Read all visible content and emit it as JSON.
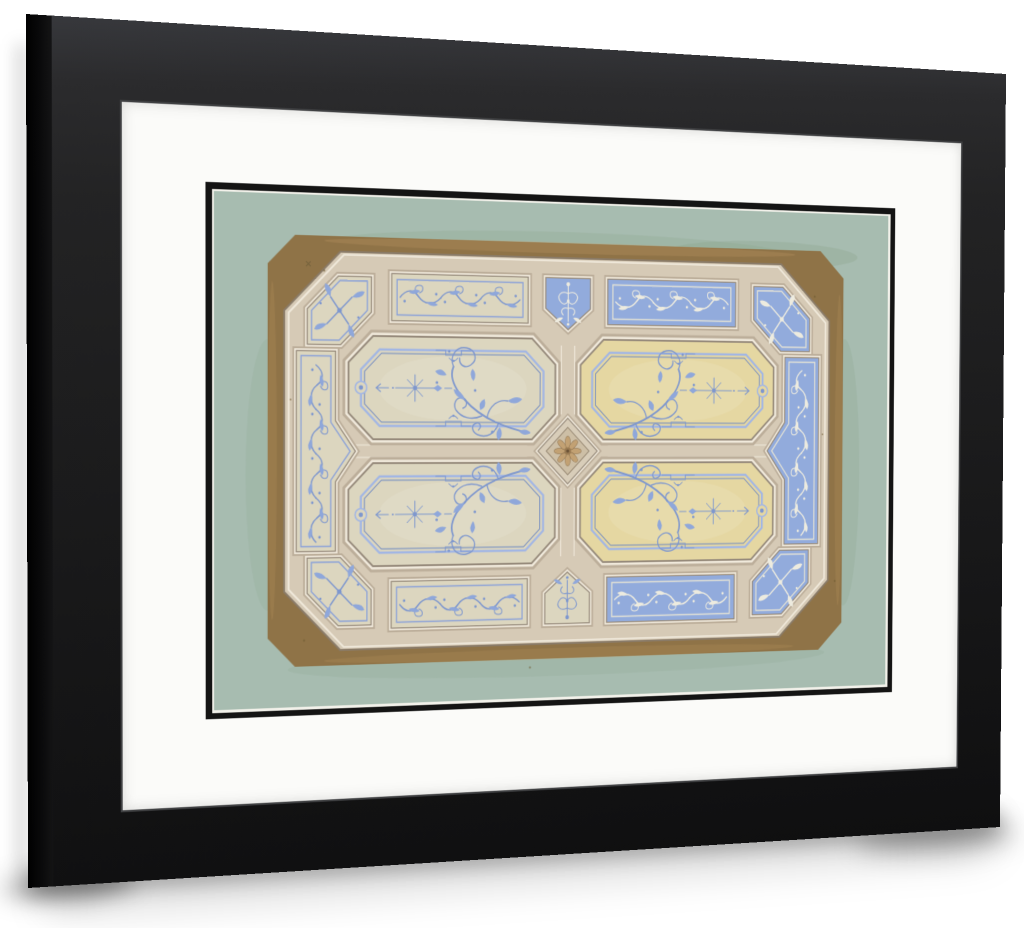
{
  "palette": {
    "page_bg": "#ffffff",
    "frame_hi": "#37383c",
    "frame_mid": "#232324",
    "frame_dark": "#0f0f10",
    "frame_wall": "#0a0a0b",
    "frame_lip": "#3f4042",
    "mat": "#fbfbf9",
    "fillet": "#141414",
    "fillet_gap": "#f2f1ea",
    "sage": "#a7bcb0",
    "sage_stain": "#7f9a7c",
    "speck": "#6f5b31",
    "brown": "#8f7347",
    "brown_hi": "#c29c66",
    "beam": "#d6cab6",
    "beam_m1": "#bcae9a",
    "beam_m2": "#f0e9db",
    "beam_m3": "#968a7b",
    "beam_edge": "#8a7b68",
    "panel_cream": "#dcd6bf",
    "panel_gold": "#e5d7a2",
    "panel_blue": "#92abdc",
    "orn_blue": "#7e97ce",
    "orn_blue_fill": "#8fa7da",
    "line_on_cream": "#8ca2d8",
    "orn_white": "#edebdf",
    "line_on_blue": "#e2e1d5",
    "cof_line_hi": "#a2b6e4",
    "cof_line_dk": "#6f89c1",
    "ros_base": "#d8cdb9",
    "ros_inner": "#cdbfa6",
    "ros_petal": "#c2a173",
    "ros_ring": "#9a7b52",
    "ros_center": "#6b5236"
  }
}
